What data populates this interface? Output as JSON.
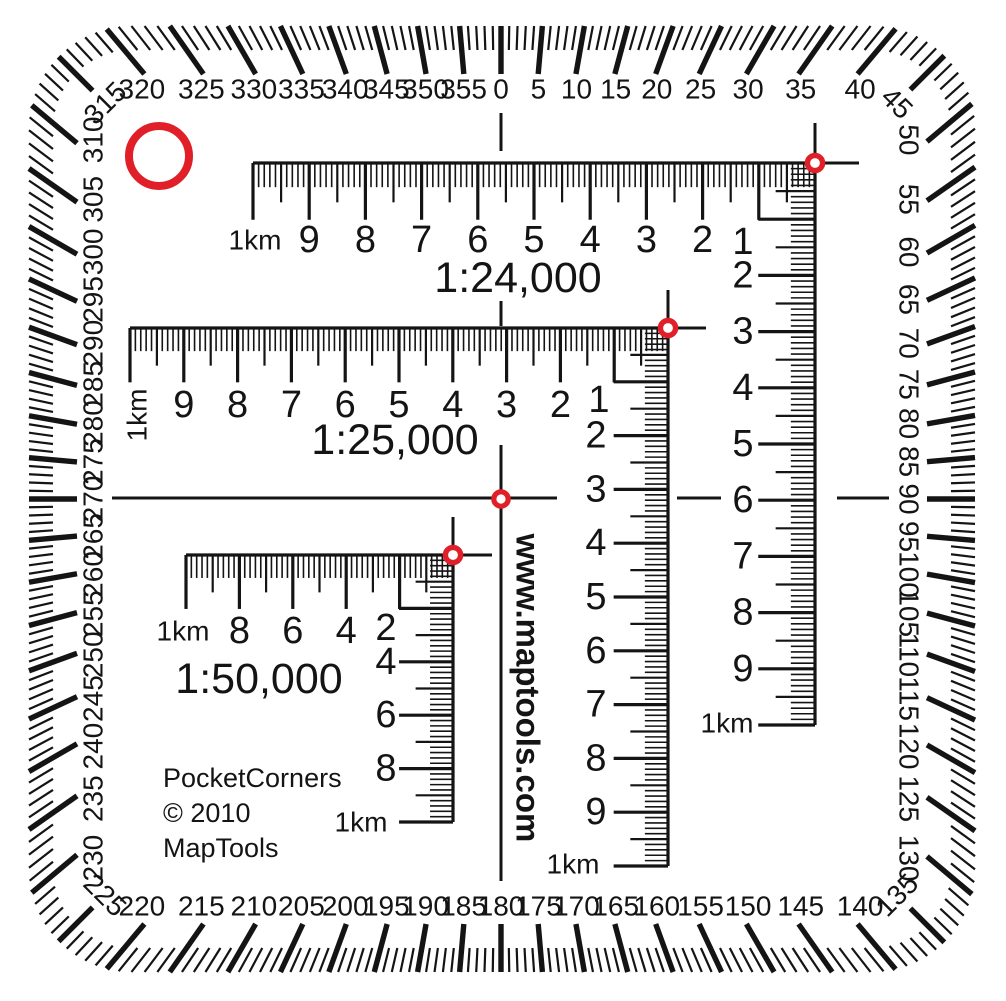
{
  "colors": {
    "ink": "#141414",
    "red": "#e01f28",
    "background": "#ffffff"
  },
  "protractor": {
    "degree_labels": [
      "0",
      "5",
      "10",
      "15",
      "20",
      "25",
      "30",
      "35",
      "40",
      "45",
      "50",
      "55",
      "60",
      "65",
      "70",
      "75",
      "80",
      "85",
      "90",
      "95",
      "100",
      "105",
      "110",
      "115",
      "120",
      "125",
      "130",
      "135",
      "140",
      "145",
      "150",
      "155",
      "160",
      "165",
      "170",
      "175",
      "180",
      "185",
      "190",
      "195",
      "200",
      "205",
      "210",
      "215",
      "220",
      "225",
      "230",
      "235",
      "240",
      "245",
      "250",
      "255",
      "260",
      "265",
      "270",
      "275",
      "280",
      "285",
      "290",
      "295",
      "300",
      "305",
      "310",
      "315",
      "320",
      "325",
      "330",
      "335",
      "340",
      "345",
      "350",
      "355"
    ]
  },
  "rulers": [
    {
      "title": "1:24,000",
      "title_x": 518,
      "title_y": 278,
      "title_size": 43,
      "cx": 815,
      "cy": 163,
      "unit": 56.2,
      "div": 10,
      "corner_label": {
        "text": "1",
        "x": 743,
        "y": 242
      },
      "h_labels": [
        [
          2,
          "2"
        ],
        [
          3,
          "3"
        ],
        [
          4,
          "4"
        ],
        [
          5,
          "5"
        ],
        [
          6,
          "6"
        ],
        [
          7,
          "7"
        ],
        [
          8,
          "8"
        ],
        [
          9,
          "9"
        ]
      ],
      "v_labels": [
        [
          2,
          "2"
        ],
        [
          3,
          "3"
        ],
        [
          4,
          "4"
        ],
        [
          5,
          "5"
        ],
        [
          6,
          "6"
        ],
        [
          7,
          "7"
        ],
        [
          8,
          "8"
        ],
        [
          9,
          "9"
        ]
      ],
      "h_end": {
        "text": "1km",
        "x": 255,
        "y": 240,
        "rot": 0
      },
      "v_end": {
        "text": "1km",
        "x": 727,
        "y": 723
      },
      "row_dy": 77,
      "col_dx": -72,
      "cross_up": 40,
      "cross_right": 44
    },
    {
      "title": "1:25,000",
      "title_x": 395,
      "title_y": 440,
      "title_size": 43,
      "cx": 668,
      "cy": 328,
      "unit": 53.8,
      "div": 10,
      "corner_label": {
        "text": "1",
        "x": 599,
        "y": 400
      },
      "h_labels": [
        [
          2,
          "2"
        ],
        [
          3,
          "3"
        ],
        [
          4,
          "4"
        ],
        [
          5,
          "5"
        ],
        [
          6,
          "6"
        ],
        [
          7,
          "7"
        ],
        [
          8,
          "8"
        ],
        [
          9,
          "9"
        ]
      ],
      "v_labels": [
        [
          2,
          "2"
        ],
        [
          3,
          "3"
        ],
        [
          4,
          "4"
        ],
        [
          5,
          "5"
        ],
        [
          6,
          "6"
        ],
        [
          7,
          "7"
        ],
        [
          8,
          "8"
        ],
        [
          9,
          "9"
        ]
      ],
      "h_end": {
        "text": "1km",
        "x": 137,
        "y": 415,
        "rot": -90
      },
      "v_end": {
        "text": "1km",
        "x": 573,
        "y": 864
      },
      "row_dy": 77,
      "col_dx": -72,
      "cross_up": 38,
      "cross_right": 38
    },
    {
      "title": "1:50,000",
      "title_x": 259,
      "title_y": 679,
      "title_size": 43,
      "cx": 453,
      "cy": 555,
      "unit": 53.4,
      "div": 5,
      "corner_label": {
        "text": "2",
        "x": 386,
        "y": 628
      },
      "h_labels": [
        [
          2,
          "4"
        ],
        [
          3,
          "6"
        ],
        [
          4,
          "8"
        ]
      ],
      "v_labels": [
        [
          2,
          "4"
        ],
        [
          3,
          "6"
        ],
        [
          4,
          "8"
        ]
      ],
      "h_end": {
        "text": "1km",
        "x": 183,
        "y": 631,
        "rot": 0
      },
      "v_end": {
        "text": "1km",
        "x": 361,
        "y": 822
      },
      "row_dy": 76,
      "col_dx": -67,
      "cross_up": 38,
      "cross_right": 39
    }
  ],
  "center_cross": {
    "segments": [
      [
        501,
        113,
        501,
        151
      ],
      [
        501,
        301,
        501,
        326
      ],
      [
        501,
        445,
        501,
        881
      ],
      [
        112,
        498,
        557,
        498
      ],
      [
        677,
        498,
        721,
        498
      ],
      [
        837,
        498,
        889,
        498
      ]
    ]
  },
  "circles": {
    "hole": {
      "x": 159,
      "y": 156,
      "r": 30,
      "sw": 8
    },
    "corners": [
      {
        "x": 815,
        "y": 163
      },
      {
        "x": 668,
        "y": 328
      },
      {
        "x": 453,
        "y": 555
      }
    ],
    "center": {
      "x": 501,
      "y": 499
    },
    "small_r": 7.6,
    "small_sw": 5.4
  },
  "url_text": {
    "text": "www.maptools.com",
    "x": 528,
    "y": 688,
    "size": 33
  },
  "credits": {
    "lines": [
      "PocketCorners",
      "© 2010",
      "MapTools"
    ],
    "x": 163,
    "y": 778,
    "line_height": 35,
    "size": 27
  }
}
